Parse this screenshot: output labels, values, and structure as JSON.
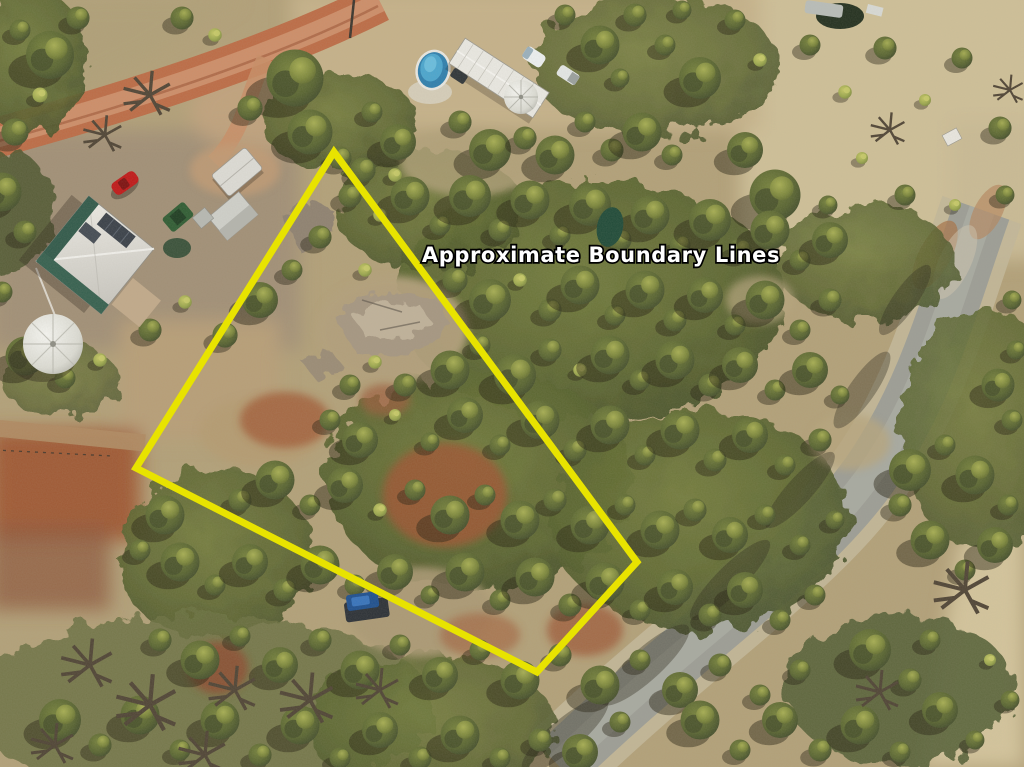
{
  "annotation": {
    "label": "Approximate Boundary Lines",
    "label_color": "#ffffff",
    "label_outline_color": "#000000",
    "boundary_color": "#e8e300",
    "boundary_points": "334,152 136,468 537,672 637,562"
  },
  "scene": {
    "description": "Aerial drone photograph of a semi-rural bushland property: homestead with white roof, sheds, water tanks, above-ground pool, red dirt road at top left, grey gravel road at right, dense eucalypt scrub inside a marked boundary"
  }
}
